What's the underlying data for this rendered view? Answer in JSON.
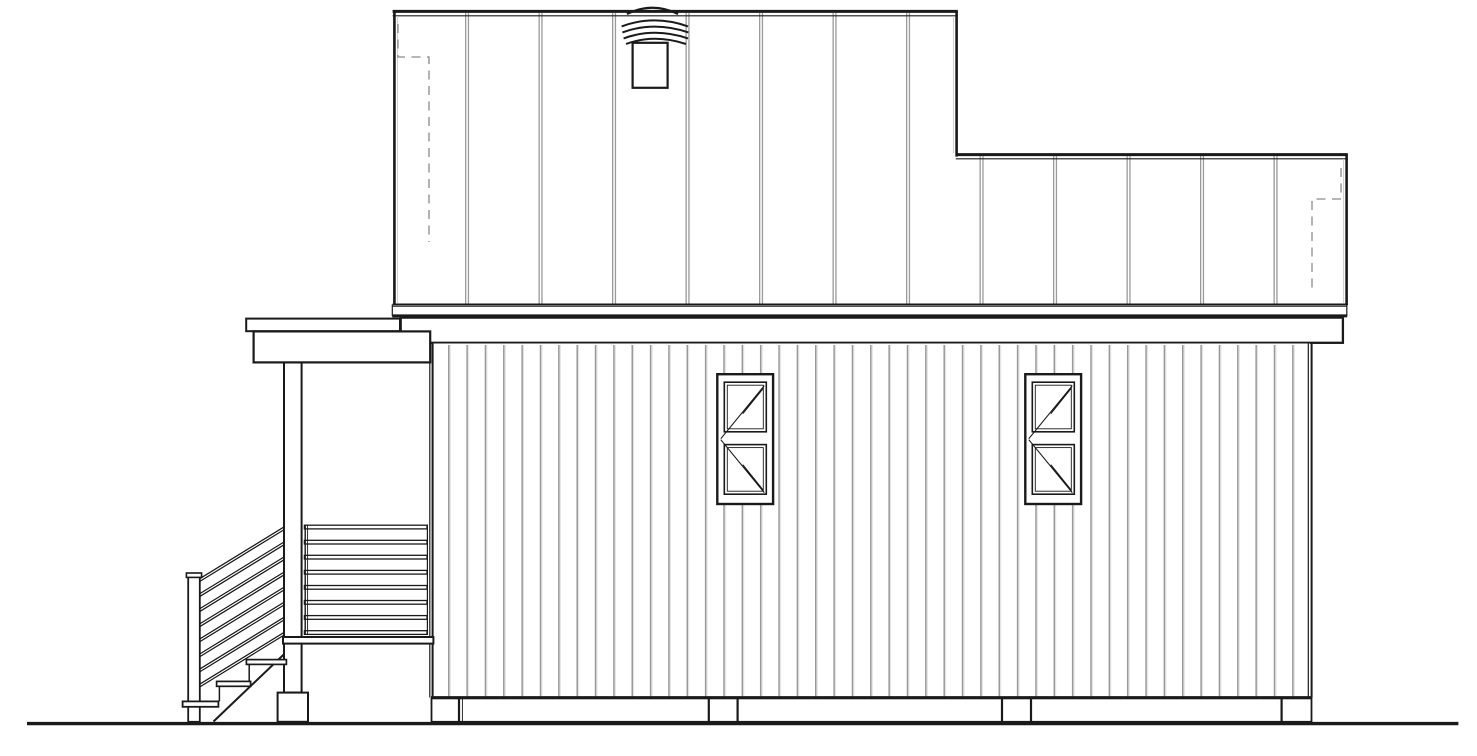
{
  "palette": {
    "paper": "#ffffff",
    "line": "#1a1a1a",
    "gray": "#9a9a9a",
    "light": "#c9c9c9",
    "dash": "#8a8a8a",
    "siding": "#999999",
    "siding_light": "#d9d9d9"
  },
  "elevation": {
    "view": "side-elevation-line-drawing",
    "upper_story_battens": 12,
    "windows": 2,
    "window_sashes_each": 2,
    "roof_vents": 1,
    "vent_louver_arcs": 4,
    "stair_diagonal_rails": 8,
    "porch_horizontal_rails": 8,
    "stair_treads": 2,
    "foundation_piers": 4
  }
}
